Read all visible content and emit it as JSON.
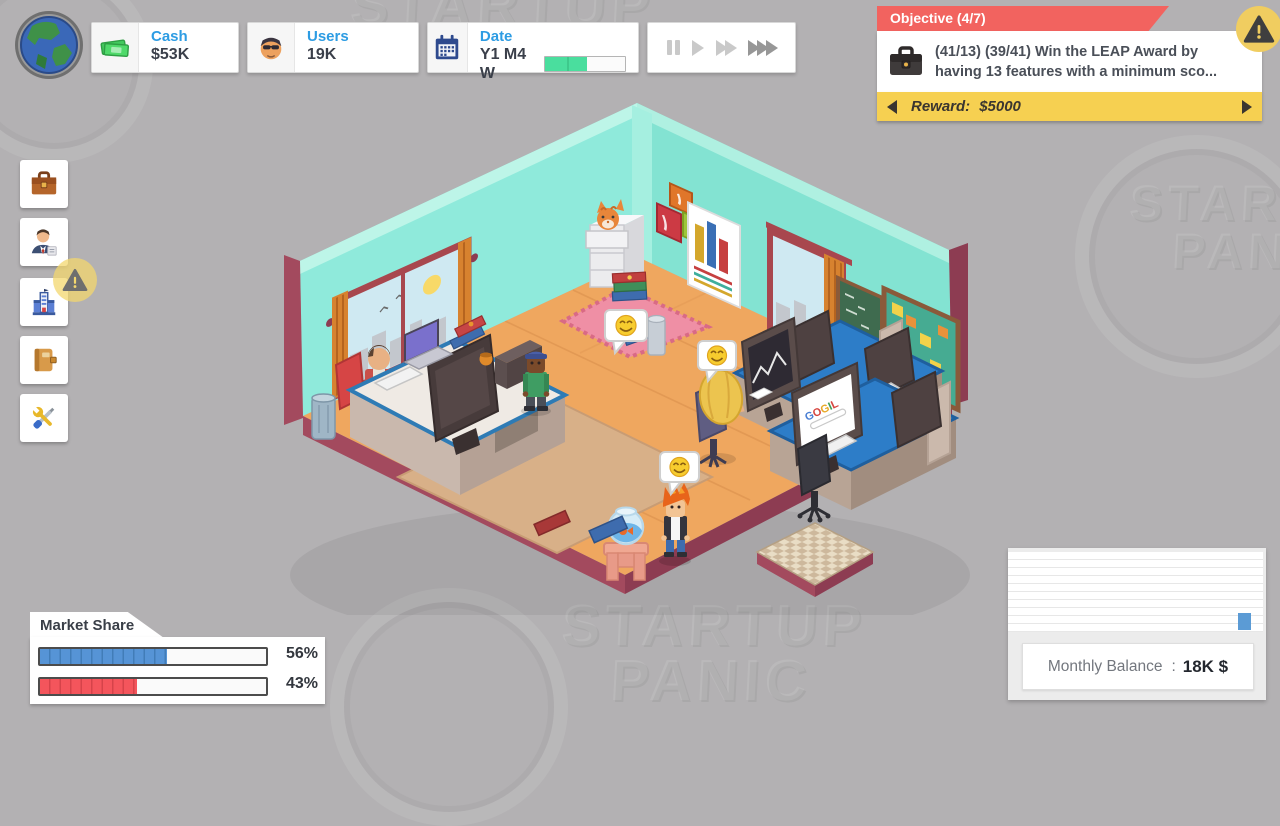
{
  "background": {
    "watermark_word1": "STARTUP",
    "watermark_word2": "PANIC"
  },
  "hud": {
    "cash": {
      "label": "Cash",
      "value": "$53K"
    },
    "users": {
      "label": "Users",
      "value": "19K"
    },
    "date": {
      "label": "Date",
      "value": "Y1 M4 W",
      "progress_pct": 52
    },
    "speed": {
      "buttons": [
        "pause",
        "play",
        "fast-forward",
        "fastest"
      ],
      "active": "fastest"
    }
  },
  "objective": {
    "header": "Objective (4/7)",
    "text": "(41/13) (39/41) Win the LEAP Award by having 13 features with a minimum sco...",
    "reward_label": "Reward:",
    "reward_value": "$5000"
  },
  "sidebar": {
    "items": [
      {
        "id": "contracts",
        "icon": "briefcase-icon"
      },
      {
        "id": "staff",
        "icon": "employee-icon"
      },
      {
        "id": "company",
        "icon": "building-icon",
        "alert": true
      },
      {
        "id": "journal",
        "icon": "notebook-icon"
      },
      {
        "id": "development",
        "icon": "tools-icon"
      }
    ]
  },
  "market_share": {
    "title": "Market Share",
    "bars": [
      {
        "name": "player",
        "pct": 56,
        "label": "56%",
        "color": "#5694d6"
      },
      {
        "name": "competitor",
        "pct": 43,
        "label": "43%",
        "color": "#f4555c"
      }
    ]
  },
  "monthly_balance": {
    "label": "Monthly Balance",
    "colon": ":",
    "value": "18K $"
  },
  "scene": {
    "monitor_letters": [
      "G",
      "O",
      "G",
      "I",
      "L"
    ],
    "speech_bubbles": [
      "smiling-emoji",
      "smiling-emoji",
      "smiling-emoji"
    ]
  },
  "colors": {
    "accent_blue": "#2d9ce3",
    "objective_red": "#f2635f",
    "reward_yellow": "#f6d051",
    "wall_teal": "#8feadb",
    "floor_wood": "#efa75f",
    "edge_maroon": "#a34a5e",
    "progress_green": "#4ade9e"
  }
}
